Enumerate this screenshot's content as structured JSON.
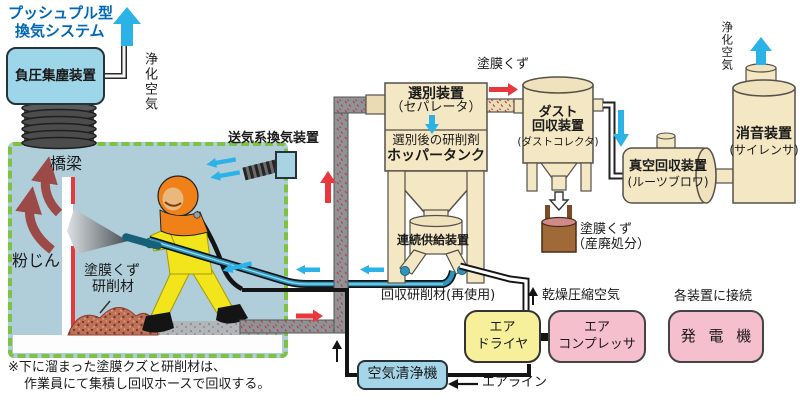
{
  "title": {
    "line1": "プッシュプル型",
    "line2": "換気システム"
  },
  "devices": {
    "neg_pressure_collector": "負圧集塵装置",
    "supply_ventilator": "送気系換気装置",
    "separator_name": "選別装置",
    "separator_sub": "（セパレータ）",
    "after_sorting": "選別後の研削剤",
    "hopper_tank": "ホッパータンク",
    "feeder": "連続供給装置",
    "dust_collector_1": "ダスト",
    "dust_collector_2": "回収装置",
    "dust_collector_sub": "(ダストコレクタ)",
    "vacuum_name": "真空回収装置",
    "vacuum_sub": "(ルーツブロワ)",
    "silencer_name": "消音装置",
    "silencer_sub": "(サイレンサ)",
    "air_dryer_1": "エア",
    "air_dryer_2": "ドライヤ",
    "compressor_1": "エア",
    "compressor_2": "コンプレッサ",
    "generator": "発 電 機",
    "air_purifier": "空気清浄機"
  },
  "flows": {
    "purified_air_left": "浄化空気",
    "purified_air_right": "浄化空気",
    "paint_scrap_top": "塗膜くず",
    "scrap_disposal_1": "塗膜くず",
    "scrap_disposal_2": "（産廃処分）",
    "recovered_abrasive": "回収研削材(再使用)",
    "dry_compressed_air": "乾燥圧縮空気",
    "connect_each_device": "各装置に接続",
    "air_line": "エアライン",
    "dust": "粉じん",
    "bridge": "橋梁",
    "debris_1": "塗膜くず",
    "debris_2": "研削材"
  },
  "note": {
    "line1": "※下に溜まった塗膜クズと研削材は、",
    "line2": "作業員にて集積し回収ホースで回収する。"
  },
  "colors": {
    "accent_blue": "#0068b7",
    "cyan_fill": "#9dd6e8",
    "tan_fill": "#f4e7c3",
    "pink_fill": "#f6bfcd",
    "yellow_fill": "#f6f09b",
    "enclosure_fill": "#b0cdda",
    "enclosure_border": "#7dc243",
    "arrow_cyan": "#2bb3e8",
    "arrow_red": "#e8373d",
    "dust_arrow": "#9b4a47"
  }
}
